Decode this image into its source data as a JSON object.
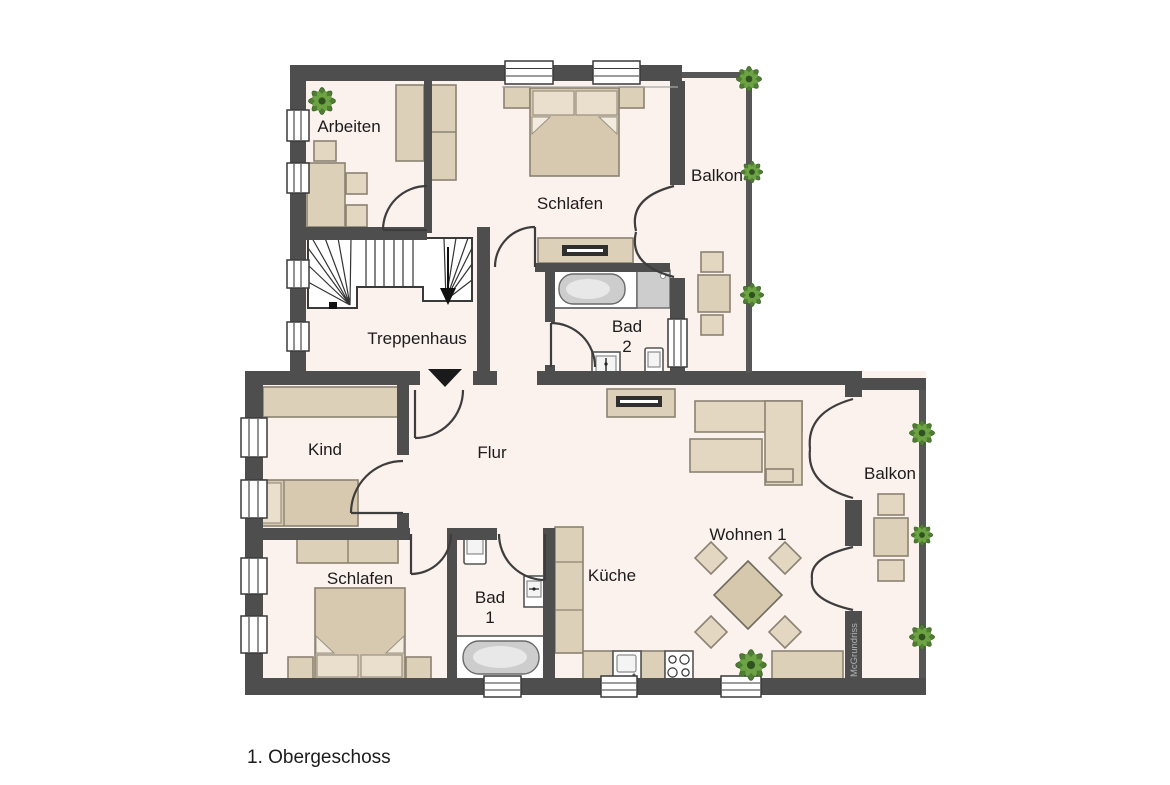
{
  "caption": "1. Obergeschoss",
  "watermark": "McGrundriss",
  "rooms": {
    "arbeiten": {
      "label": "Arbeiten"
    },
    "schlafen_top": {
      "label": "Schlafen"
    },
    "balkon_top": {
      "label": "Balkon"
    },
    "bad2": {
      "line1": "Bad",
      "line2": "2"
    },
    "treppenhaus": {
      "label": "Treppenhaus"
    },
    "kind": {
      "label": "Kind"
    },
    "flur": {
      "label": "Flur"
    },
    "schlafen_bottom": {
      "label": "Schlafen"
    },
    "bad1": {
      "line1": "Bad",
      "line2": "1"
    },
    "kueche": {
      "label": "Küche"
    },
    "wohnen": {
      "label": "Wohnen 1"
    },
    "balkon_bottom": {
      "label": "Balkon"
    }
  },
  "colors": {
    "wall": "#4e4e4e",
    "floor": "#fbf1ed",
    "furniture": "#dcd0b8",
    "furniture_border": "#8b8272",
    "plant_green": "#4f7d33",
    "text": "#1c1c1c",
    "watermark_text": "#b3b3b3"
  }
}
